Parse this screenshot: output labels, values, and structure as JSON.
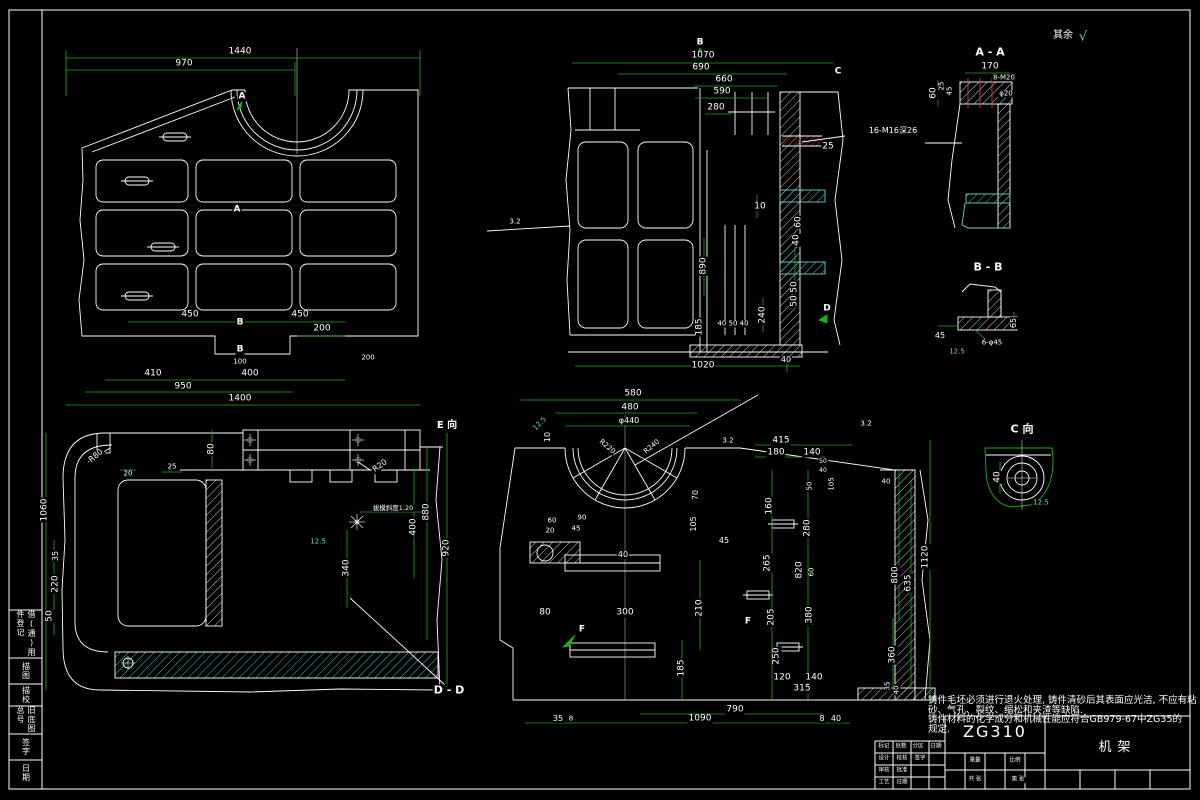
{
  "drawing": {
    "surface_note_prefix": "其余",
    "surface_note_symbol": "√",
    "notes_lines": [
      "铸件毛坯必须进行退火处理, 铸件清砂后其表面应光洁, 不应有粘",
      "砂、气孔、裂纹、缩松和夹渣等缺陷.",
      "铸件材料的化学成分和机械性能应符合GB979-67中ZG35的",
      "规定."
    ],
    "title_block": {
      "material": "ZG310",
      "part_name": "机架"
    },
    "margin_fields": [
      {
        "label": "借(通)用件登记",
        "y": 610,
        "h": 48
      },
      {
        "label": "描图",
        "y": 658,
        "h": 26
      },
      {
        "label": "描校",
        "y": 684,
        "h": 22
      },
      {
        "label": "旧底图总号",
        "y": 706,
        "h": 28
      },
      {
        "label": "签字",
        "y": 734,
        "h": 26
      },
      {
        "label": "日期",
        "y": 760,
        "h": 26
      }
    ]
  },
  "annotations": [
    {
      "t": "1440",
      "x": 240,
      "y": 52
    },
    {
      "t": "970",
      "x": 184,
      "y": 64
    },
    {
      "t": "A",
      "x": 242,
      "y": 97,
      "b": 1
    },
    {
      "t": "A",
      "x": 237,
      "y": 210,
      "b": 1
    },
    {
      "t": "450",
      "x": 190,
      "y": 315
    },
    {
      "t": "B",
      "x": 240,
      "y": 323,
      "b": 1
    },
    {
      "t": "450",
      "x": 300,
      "y": 315
    },
    {
      "t": "200",
      "x": 322,
      "y": 329
    },
    {
      "t": "B",
      "x": 240,
      "y": 350,
      "b": 1
    },
    {
      "t": "100",
      "x": 240,
      "y": 362,
      "fs": 7
    },
    {
      "t": "200",
      "x": 368,
      "y": 358,
      "fs": 7
    },
    {
      "t": "410",
      "x": 153,
      "y": 374
    },
    {
      "t": "400",
      "x": 250,
      "y": 374
    },
    {
      "t": "950",
      "x": 183,
      "y": 387
    },
    {
      "t": "1400",
      "x": 240,
      "y": 399
    },
    {
      "t": "B",
      "x": 700,
      "y": 43,
      "b": 1
    },
    {
      "t": "C",
      "x": 838,
      "y": 72,
      "b": 1
    },
    {
      "t": "1070",
      "x": 703,
      "y": 56
    },
    {
      "t": "690",
      "x": 701,
      "y": 68
    },
    {
      "t": "660",
      "x": 724,
      "y": 80
    },
    {
      "t": "590",
      "x": 722,
      "y": 92
    },
    {
      "t": "280",
      "x": 716,
      "y": 108
    },
    {
      "t": "16-M16深26",
      "x": 893,
      "y": 131,
      "fs": 8
    },
    {
      "t": "25",
      "x": 828,
      "y": 147
    },
    {
      "t": "10",
      "x": 760,
      "y": 207
    },
    {
      "t": "60",
      "x": 799,
      "y": 222,
      "r": -90
    },
    {
      "t": "40",
      "x": 797,
      "y": 240,
      "r": -90
    },
    {
      "t": "50",
      "x": 795,
      "y": 287,
      "r": -90
    },
    {
      "t": "50",
      "x": 795,
      "y": 301,
      "r": -90
    },
    {
      "t": "240",
      "x": 763,
      "y": 315,
      "r": -90
    },
    {
      "t": "40 50 40",
      "x": 733,
      "y": 324,
      "fs": 7
    },
    {
      "t": "890",
      "x": 704,
      "y": 266,
      "r": -90
    },
    {
      "t": "185",
      "x": 700,
      "y": 327,
      "r": -90
    },
    {
      "t": "1020",
      "x": 703,
      "y": 366
    },
    {
      "t": "40",
      "x": 786,
      "y": 360,
      "fs": 8
    },
    {
      "t": "D",
      "x": 827,
      "y": 309,
      "b": 1
    },
    {
      "t": "3.2",
      "x": 515,
      "y": 222,
      "fs": 7
    },
    {
      "t": "A - A",
      "x": 990,
      "y": 52,
      "b": 1,
      "fs": 11,
      "n": "section-title-a-a"
    },
    {
      "t": "170",
      "x": 990,
      "y": 67
    },
    {
      "t": "8-M20",
      "x": 1004,
      "y": 78,
      "fs": 7
    },
    {
      "t": "25",
      "x": 942,
      "y": 86,
      "r": -90,
      "fs": 7
    },
    {
      "t": "45",
      "x": 950,
      "y": 91,
      "r": -90,
      "fs": 7
    },
    {
      "t": "60",
      "x": 934,
      "y": 93,
      "r": -90
    },
    {
      "t": "φ20",
      "x": 1006,
      "y": 94,
      "fs": 7
    },
    {
      "t": "B - B",
      "x": 988,
      "y": 267,
      "b": 1,
      "fs": 11,
      "n": "section-title-b-b"
    },
    {
      "t": "45",
      "x": 940,
      "y": 336,
      "fs": 8
    },
    {
      "t": "65",
      "x": 1014,
      "y": 323,
      "r": -90,
      "fs": 8
    },
    {
      "t": "6-φ45",
      "x": 992,
      "y": 343,
      "fs": 7
    },
    {
      "t": "12.5",
      "x": 957,
      "y": 352,
      "c": "#6fd2d2",
      "fs": 7
    },
    {
      "t": "C 向",
      "x": 1022,
      "y": 429,
      "b": 1,
      "fs": 11,
      "n": "view-title-c"
    },
    {
      "t": "40",
      "x": 998,
      "y": 477,
      "r": -90
    },
    {
      "t": "12.5",
      "x": 1041,
      "y": 503,
      "c": "#6fd2d2",
      "fs": 7
    },
    {
      "t": "1060",
      "x": 45,
      "y": 510,
      "r": -90
    },
    {
      "t": "35",
      "x": 56,
      "y": 556,
      "r": -90,
      "fs": 8
    },
    {
      "t": "220",
      "x": 56,
      "y": 584,
      "r": -90
    },
    {
      "t": "50",
      "x": 50,
      "y": 616,
      "r": -90
    },
    {
      "t": "20",
      "x": 128,
      "y": 474,
      "fs": 7
    },
    {
      "t": "25",
      "x": 172,
      "y": 467,
      "fs": 7
    },
    {
      "t": "80",
      "x": 212,
      "y": 449,
      "r": -90
    },
    {
      "t": "R20",
      "x": 380,
      "y": 466,
      "r": -35,
      "fs": 8
    },
    {
      "t": "880",
      "x": 427,
      "y": 512,
      "r": -90
    },
    {
      "t": "400",
      "x": 414,
      "y": 527,
      "r": -90
    },
    {
      "t": "920",
      "x": 447,
      "y": 548,
      "r": -90
    },
    {
      "t": "拔模斜度1:20",
      "x": 393,
      "y": 508,
      "fs": 6.5
    },
    {
      "t": "340",
      "x": 347,
      "y": 568,
      "r": -90
    },
    {
      "t": "R80",
      "x": 96,
      "y": 456,
      "r": -40,
      "fs": 8
    },
    {
      "t": "12.5",
      "x": 318,
      "y": 542,
      "c": "#6fd2d2",
      "fs": 7
    },
    {
      "t": "D - D",
      "x": 449,
      "y": 690,
      "b": 1,
      "fs": 11,
      "n": "section-title-d-d"
    },
    {
      "t": "E 向",
      "x": 447,
      "y": 426,
      "b": 1,
      "fs": 10,
      "n": "view-title-e"
    },
    {
      "t": "580",
      "x": 633,
      "y": 394
    },
    {
      "t": "480",
      "x": 630,
      "y": 408
    },
    {
      "t": "φ440",
      "x": 629,
      "y": 421,
      "fs": 8
    },
    {
      "t": "R220",
      "x": 607,
      "y": 447,
      "r": 40,
      "fs": 7
    },
    {
      "t": "R240",
      "x": 652,
      "y": 447,
      "r": -40,
      "fs": 7
    },
    {
      "t": "10",
      "x": 548,
      "y": 437,
      "r": -90,
      "fs": 8
    },
    {
      "t": "12.5",
      "x": 540,
      "y": 424,
      "r": -45,
      "c": "#6fd2d2",
      "fs": 7
    },
    {
      "t": "3.2",
      "x": 728,
      "y": 441,
      "fs": 7
    },
    {
      "t": "60",
      "x": 552,
      "y": 521,
      "fs": 7
    },
    {
      "t": "20",
      "x": 550,
      "y": 531,
      "fs": 7
    },
    {
      "t": "90",
      "x": 582,
      "y": 518,
      "fs": 7
    },
    {
      "t": "45",
      "x": 576,
      "y": 529,
      "fs": 7
    },
    {
      "t": "40",
      "x": 623,
      "y": 555,
      "fs": 8
    },
    {
      "t": "70",
      "x": 696,
      "y": 495,
      "r": -90,
      "fs": 8
    },
    {
      "t": "105",
      "x": 694,
      "y": 524,
      "r": -90,
      "fs": 8
    },
    {
      "t": "45",
      "x": 724,
      "y": 541,
      "fs": 8
    },
    {
      "t": "80",
      "x": 545,
      "y": 613
    },
    {
      "t": "300",
      "x": 625,
      "y": 613
    },
    {
      "t": "210",
      "x": 700,
      "y": 608,
      "r": -90
    },
    {
      "t": "185",
      "x": 682,
      "y": 668,
      "r": -90
    },
    {
      "t": "F",
      "x": 582,
      "y": 630,
      "b": 1
    },
    {
      "t": "F",
      "x": 748,
      "y": 622,
      "b": 1
    },
    {
      "t": "205",
      "x": 772,
      "y": 617,
      "r": -90
    },
    {
      "t": "250",
      "x": 777,
      "y": 656,
      "r": -90
    },
    {
      "t": "350",
      "x": 812,
      "y": 617,
      "r": -90
    },
    {
      "t": "120",
      "x": 782,
      "y": 678
    },
    {
      "t": "140",
      "x": 814,
      "y": 678
    },
    {
      "t": "315",
      "x": 802,
      "y": 689
    },
    {
      "t": "790",
      "x": 735,
      "y": 710
    },
    {
      "t": "1090",
      "x": 700,
      "y": 719
    },
    {
      "t": "8",
      "x": 822,
      "y": 719,
      "fs": 8
    },
    {
      "t": "40",
      "x": 836,
      "y": 719,
      "fs": 8
    },
    {
      "t": "35",
      "x": 558,
      "y": 719,
      "fs": 8
    },
    {
      "t": "8",
      "x": 571,
      "y": 719,
      "fs": 7
    },
    {
      "t": "415",
      "x": 781,
      "y": 441
    },
    {
      "t": "180",
      "x": 776,
      "y": 453
    },
    {
      "t": "140",
      "x": 812,
      "y": 453
    },
    {
      "t": "50",
      "x": 823,
      "y": 462,
      "fs": 6
    },
    {
      "t": "40",
      "x": 823,
      "y": 471,
      "fs": 6
    },
    {
      "t": "105",
      "x": 832,
      "y": 484,
      "r": -90,
      "fs": 7
    },
    {
      "t": "50",
      "x": 810,
      "y": 486,
      "r": -90,
      "fs": 7
    },
    {
      "t": "160",
      "x": 770,
      "y": 506,
      "r": -90
    },
    {
      "t": "280",
      "x": 808,
      "y": 528,
      "r": -90
    },
    {
      "t": "265",
      "x": 768,
      "y": 563,
      "r": -90
    },
    {
      "t": "820",
      "x": 800,
      "y": 570,
      "r": -90
    },
    {
      "t": "60",
      "x": 812,
      "y": 572,
      "r": -90,
      "fs": 7
    },
    {
      "t": "380",
      "x": 810,
      "y": 615,
      "r": -90
    },
    {
      "t": "1120",
      "x": 926,
      "y": 557,
      "r": -90
    },
    {
      "t": "800",
      "x": 896,
      "y": 575,
      "r": -90
    },
    {
      "t": "635",
      "x": 909,
      "y": 583,
      "r": -90
    },
    {
      "t": "360",
      "x": 893,
      "y": 655,
      "r": -90
    },
    {
      "t": "40",
      "x": 886,
      "y": 482,
      "fs": 7
    },
    {
      "t": "3.2",
      "x": 866,
      "y": 424,
      "fs": 7
    },
    {
      "t": "35",
      "x": 888,
      "y": 686,
      "r": -90,
      "fs": 7
    },
    {
      "t": "40",
      "x": 897,
      "y": 690,
      "r": -90,
      "fs": 7
    },
    {
      "t": "其余",
      "x": 1063,
      "y": 36,
      "fs": 10,
      "n": "surface-finish-note"
    },
    {
      "t": "√",
      "x": 1083,
      "y": 37,
      "c": "#6fd2d2",
      "fs": 13,
      "n": "roughness-symbol"
    },
    {
      "t": "标记",
      "x": 884,
      "y": 747,
      "fs": 5.5,
      "n": "title-block-label"
    },
    {
      "t": "处数",
      "x": 901,
      "y": 747,
      "fs": 5.5,
      "n": "title-block-label"
    },
    {
      "t": "分区",
      "x": 918,
      "y": 747,
      "fs": 5.5,
      "n": "title-block-label"
    },
    {
      "t": "日期",
      "x": 936,
      "y": 747,
      "fs": 5.5,
      "n": "title-block-label"
    },
    {
      "t": "设计",
      "x": 884,
      "y": 759,
      "fs": 5.5,
      "n": "title-block-label"
    },
    {
      "t": "校核",
      "x": 902,
      "y": 759,
      "fs": 5.5,
      "n": "title-block-label"
    },
    {
      "t": "签字",
      "x": 920,
      "y": 759,
      "fs": 5.5,
      "n": "title-block-label"
    },
    {
      "t": "审核",
      "x": 884,
      "y": 771,
      "fs": 5.5,
      "n": "title-block-label"
    },
    {
      "t": "批准",
      "x": 902,
      "y": 771,
      "fs": 5.5,
      "n": "title-block-label"
    },
    {
      "t": "工艺",
      "x": 884,
      "y": 783,
      "fs": 5.5,
      "n": "title-block-label"
    },
    {
      "t": "日期",
      "x": 902,
      "y": 783,
      "fs": 5.5,
      "n": "title-block-label"
    },
    {
      "t": "重量",
      "x": 975,
      "y": 761,
      "fs": 5.5,
      "n": "title-block-label"
    },
    {
      "t": "比例",
      "x": 1015,
      "y": 761,
      "fs": 5.5,
      "n": "title-block-label"
    },
    {
      "t": "共 张",
      "x": 975,
      "y": 780,
      "fs": 5.5,
      "n": "title-block-label"
    },
    {
      "t": "第 张",
      "x": 1018,
      "y": 780,
      "fs": 5.5,
      "n": "title-block-label"
    }
  ]
}
